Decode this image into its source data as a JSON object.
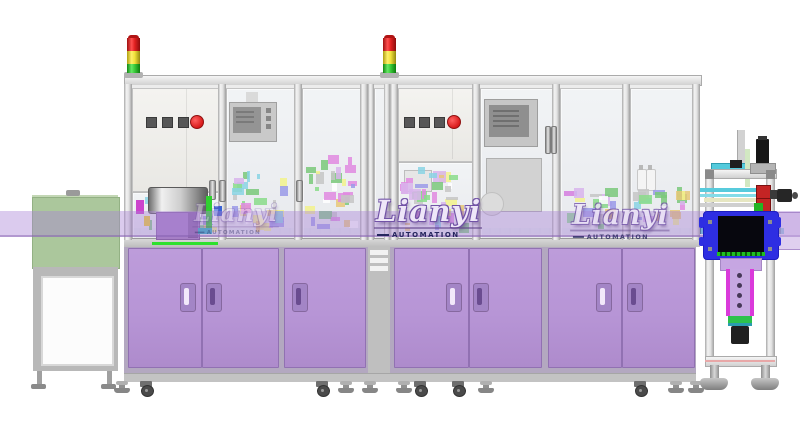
{
  "watermark": {
    "brand": "Lianyi",
    "subtitle": "AUTOMATION"
  },
  "colors": {
    "cabinet_purple": "#b795d6",
    "band_purple": "rgba(170,132,214,0.42)",
    "signal_red": "#e02020",
    "signal_yellow": "#f0e03a",
    "signal_green": "#38c838",
    "fixture_blue": "#2e2ee2",
    "conveyor_teal": "#35a6ba",
    "infeed_green": "#abc79c",
    "frame_gray": "#e3e3e3",
    "internals_palette": [
      "#8adc8a",
      "#e08ae0",
      "#8ad4e4",
      "#f2f28c",
      "#9a9ae8",
      "#ffffff",
      "#c6c6c6",
      "#d8b4ec",
      "#7ac87a",
      "#e8c878"
    ]
  }
}
